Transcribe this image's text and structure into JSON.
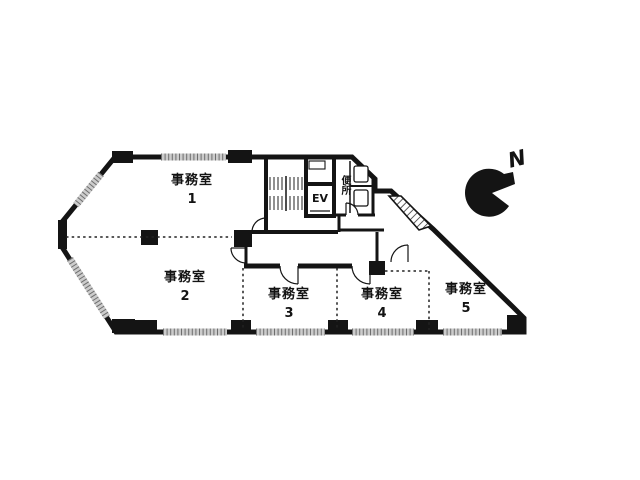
{
  "plan": {
    "rooms": [
      {
        "name": "事務室",
        "number": "1"
      },
      {
        "name": "事務室",
        "number": "2"
      },
      {
        "name": "事務室",
        "number": "3"
      },
      {
        "name": "事務室",
        "number": "4"
      },
      {
        "name": "事務室",
        "number": "5"
      }
    ],
    "elevator_label": "EV",
    "toilet_label": "便所",
    "compass_label": "N"
  },
  "colors": {
    "wall": "#141414",
    "window_strip_light": "#c9c9c9",
    "window_strip_dark": "#6e6e6e",
    "background": "#ffffff"
  }
}
